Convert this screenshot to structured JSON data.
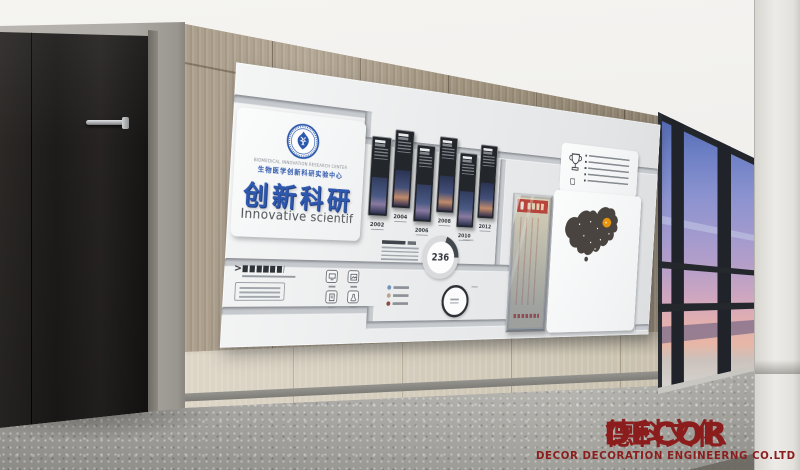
{
  "board": {
    "emblem_caption_en": "BIOMEDICAL INNOVATION RESEARCH CENTER",
    "emblem_caption_cn": "生物医学创新科研实验中心",
    "title_cn": "创新科研",
    "title_en": "Innovative scientif",
    "notice_marker": ">",
    "timeline_years": [
      "2002",
      "2004",
      "2006",
      "2008",
      "2010",
      "2012"
    ],
    "donut_value": "236"
  },
  "watermark": {
    "brand_latin": "DECOR",
    "brand_cjk": "德科文化",
    "subtitle": "DECOR DECORATION ENGINEERNG CO.LTD"
  },
  "colors": {
    "title_blue": "#2e57ae",
    "brand_red": "#8b1d1d",
    "map_dark": "#4a4440",
    "map_highlight": "#e8940c",
    "sky_top": "#4d64ab",
    "sky_horizon": "#e2afaf",
    "wood_upper": "#a69a87",
    "wood_lower": "#d7cfc0"
  }
}
